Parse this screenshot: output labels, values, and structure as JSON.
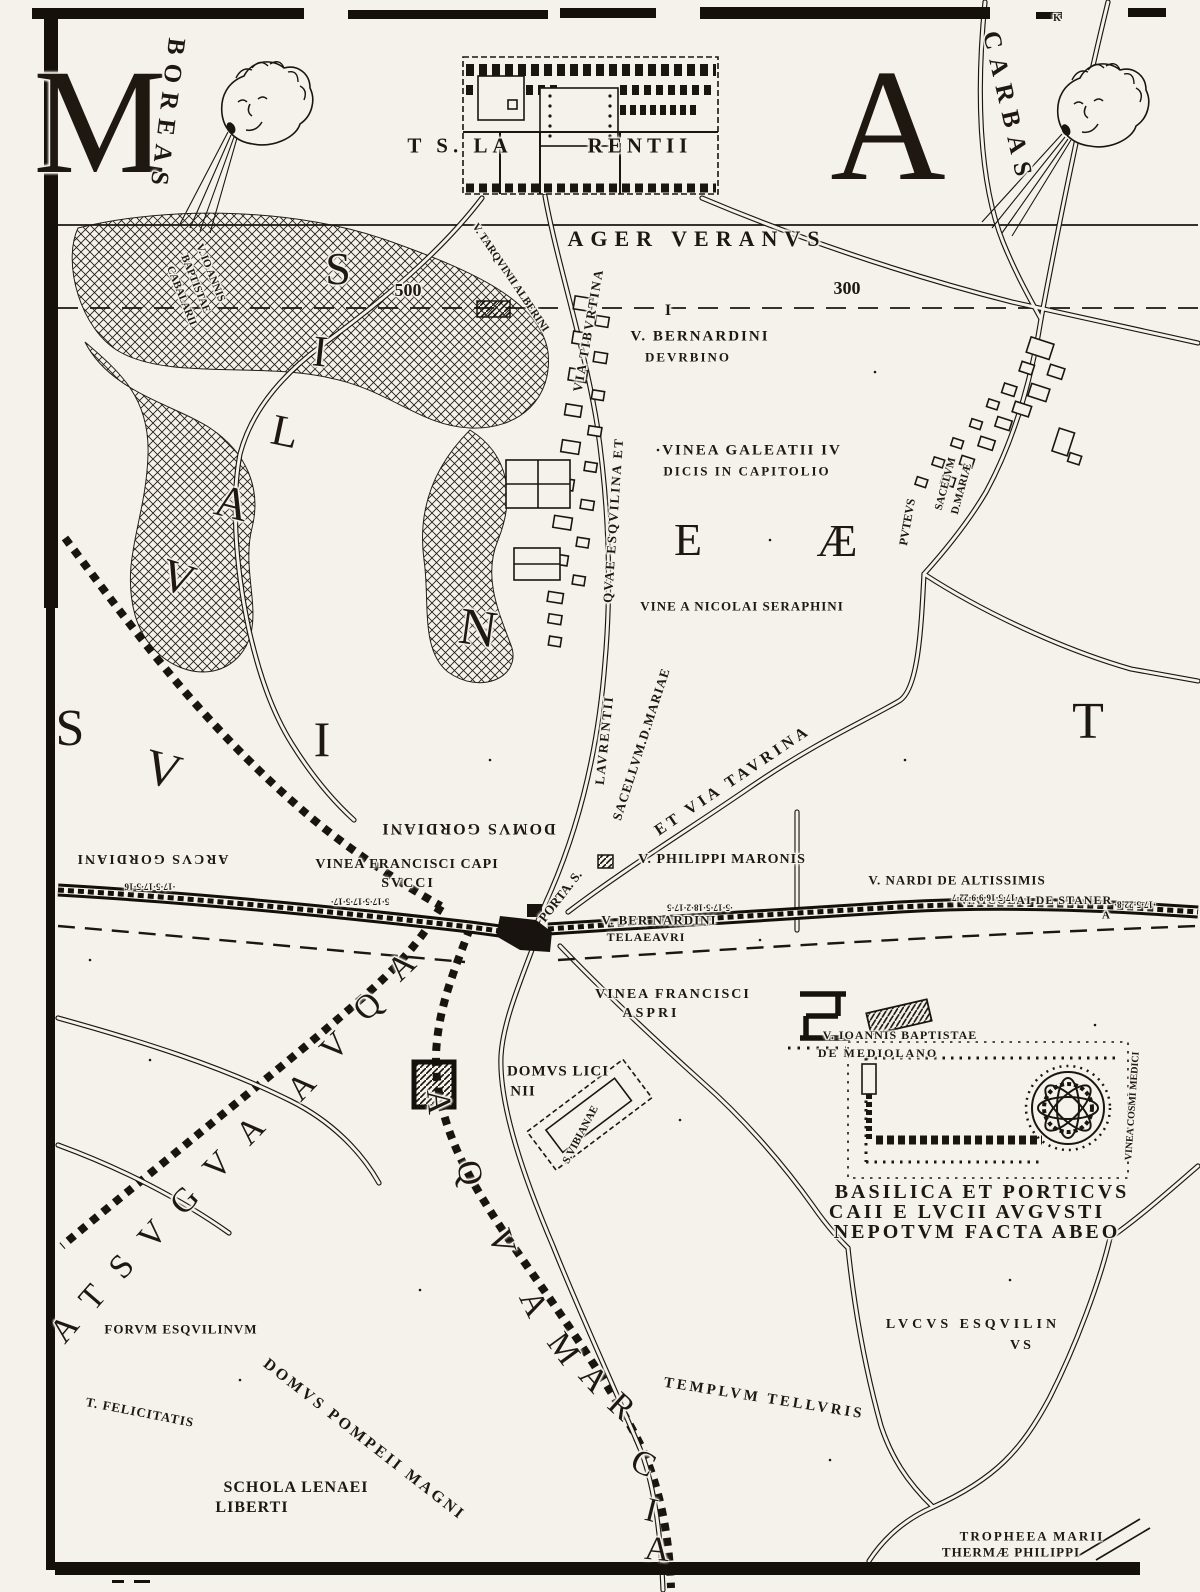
{
  "colors": {
    "paper": "#f5f2ec",
    "ink": "#1f1811"
  },
  "icons": {
    "left_wind_head": "boreas-cherub-head-icon",
    "right_wind_head": "carbas-cherub-head-icon"
  },
  "labels": [
    {
      "n": "sheet-letter-left",
      "t": "M",
      "x": 100,
      "y": 122,
      "s": 150,
      "c": "big"
    },
    {
      "n": "sheet-letter-right",
      "t": "A",
      "x": 888,
      "y": 125,
      "s": 160,
      "c": "big"
    },
    {
      "n": "wind-label-boreas",
      "t": "BOREAS",
      "x": 167,
      "y": 116,
      "s": 25,
      "r": 97,
      "ls": 9
    },
    {
      "n": "wind-label-carbas",
      "t": "CARBAS",
      "x": 1008,
      "y": 108,
      "s": 25,
      "r": 77,
      "ls": 9
    },
    {
      "n": "church-label-left",
      "t": "T S. LA",
      "x": 460,
      "y": 146,
      "s": 21,
      "ls": 5
    },
    {
      "n": "church-label-right",
      "t": "RENTII",
      "x": 640,
      "y": 146,
      "s": 21,
      "ls": 5
    },
    {
      "n": "region-ager-veranus",
      "t": "AGER VERANVS",
      "x": 697,
      "y": 239,
      "s": 22,
      "ls": 7
    },
    {
      "n": "scale-number-500",
      "t": "500",
      "x": 408,
      "y": 290,
      "s": 18
    },
    {
      "n": "scale-number-300",
      "t": "300",
      "x": 847,
      "y": 288,
      "s": 18
    },
    {
      "n": "vineyard-ioannis-cabalarii-1",
      "t": "V. IO ANNIS",
      "x": 210,
      "y": 273,
      "s": 11,
      "r": 68
    },
    {
      "n": "vineyard-ioannis-cabalarii-2",
      "t": "BAPTISTAE",
      "x": 195,
      "y": 284,
      "s": 11,
      "r": 68
    },
    {
      "n": "vineyard-ioannis-cabalarii-3",
      "t": "CABALARII",
      "x": 181,
      "y": 296,
      "s": 11,
      "r": 68
    },
    {
      "n": "vineyard-tarquinii",
      "t": "V. TARQVINII ALBERINI",
      "x": 510,
      "y": 278,
      "s": 11,
      "r": 56
    },
    {
      "n": "road-via-tiburtina",
      "t": "VIA TIBVRTINA",
      "x": 588,
      "y": 330,
      "s": 13,
      "r": -80,
      "ls": 2
    },
    {
      "n": "road-esquilina",
      "t": "QVAE ESQVILINA ET",
      "x": 613,
      "y": 520,
      "s": 13,
      "r": -86,
      "ls": 2
    },
    {
      "n": "road-laurentii",
      "t": "LAVRENTII",
      "x": 604,
      "y": 740,
      "s": 13,
      "r": -84,
      "ls": 2
    },
    {
      "n": "road-porta-s",
      "t": "PORTA. S.",
      "x": 560,
      "y": 896,
      "s": 13,
      "r": -52
    },
    {
      "n": "road-sacellum-mariae",
      "t": "SACELLVM.D.MARIAE",
      "x": 641,
      "y": 744,
      "s": 13,
      "r": -72,
      "ls": 1
    },
    {
      "n": "road-via-taurina",
      "t": "ET VIA TAVRINA",
      "x": 733,
      "y": 781,
      "s": 16,
      "r": -34,
      "ls": 4
    },
    {
      "n": "vineyard-bernardini-urbino-1",
      "t": "V. BERNARDINI",
      "x": 700,
      "y": 337,
      "s": 15,
      "ls": 2
    },
    {
      "n": "vineyard-bernardini-urbino-2",
      "t": "DEVRBINO",
      "x": 688,
      "y": 357,
      "s": 13,
      "ls": 2
    },
    {
      "n": "vineyard-galeatii-1",
      "t": "VINEA GALEATII IV",
      "x": 752,
      "y": 451,
      "s": 15,
      "ls": 2
    },
    {
      "n": "vineyard-galeatii-2",
      "t": "DICIS IN CAPITOLIO",
      "x": 747,
      "y": 471,
      "s": 13,
      "ls": 2
    },
    {
      "n": "sacellum-d-mariae-1",
      "t": "SACELVM",
      "x": 946,
      "y": 484,
      "s": 11,
      "r": -75
    },
    {
      "n": "sacellum-d-mariae-2",
      "t": "D.MARIÆ",
      "x": 962,
      "y": 489,
      "s": 11,
      "r": -75
    },
    {
      "n": "puteus",
      "t": "PVTEVS",
      "x": 907,
      "y": 522,
      "s": 12,
      "r": -80
    },
    {
      "n": "vineyard-nicolai-seraphini",
      "t": "VINE A NICOLAI SERAPHINI",
      "x": 742,
      "y": 606,
      "s": 13,
      "ls": 1
    },
    {
      "n": "domus-gordiani",
      "t": "DOMVS GORDIANI",
      "x": 468,
      "y": 828,
      "s": 16,
      "r": 180,
      "ls": 2
    },
    {
      "n": "arcus-gordiani",
      "t": "ARCVS GORDIANI",
      "x": 152,
      "y": 858,
      "s": 14,
      "r": 180,
      "ls": 2
    },
    {
      "n": "vineyard-francisci-capisucci-1",
      "t": "VINEA FRANCISCI CAPI",
      "x": 407,
      "y": 865,
      "s": 14,
      "ls": 1
    },
    {
      "n": "vineyard-francisci-capisucci-2",
      "t": "SVCCI",
      "x": 408,
      "y": 884,
      "s": 14,
      "ls": 2
    },
    {
      "n": "vineyard-philippi-maronis",
      "t": "V. PHILIPPI MARONIS",
      "x": 722,
      "y": 860,
      "s": 14,
      "ls": 1
    },
    {
      "n": "vineyard-nardi-altissimis",
      "t": "V. NARDI DE ALTISSIMIS",
      "x": 957,
      "y": 880,
      "s": 13,
      "ls": 1
    },
    {
      "n": "vineyard-nicolai-staner",
      "t": "V.NICOLAI DE STANER",
      "x": 1036,
      "y": 900,
      "s": 12,
      "ls": 1
    },
    {
      "n": "staner-mark",
      "t": "A",
      "x": 1106,
      "y": 916,
      "s": 11
    },
    {
      "n": "vineyard-bernardini-telaeauri-1",
      "t": "V. BER NARDINI",
      "x": 659,
      "y": 920,
      "s": 13,
      "ls": 1
    },
    {
      "n": "vineyard-bernardini-telaeauri-2",
      "t": "TELAEAVRI",
      "x": 646,
      "y": 937,
      "s": 12,
      "ls": 1
    },
    {
      "n": "wall-measure-1",
      "t": "·17·5·17·5·16",
      "x": 150,
      "y": 886,
      "s": 9,
      "r": 180
    },
    {
      "n": "wall-measure-2",
      "t": "5·17·5·17·5·17·",
      "x": 360,
      "y": 901,
      "s": 9,
      "r": 180
    },
    {
      "n": "wall-measure-3",
      "t": "·5·17·5·18·2·17·5",
      "x": 700,
      "y": 907,
      "s": 9,
      "r": 180
    },
    {
      "n": "wall-measure-4",
      "t": "·17·5·16·9·9·22·7",
      "x": 985,
      "y": 897,
      "s": 9,
      "r": 180
    },
    {
      "n": "wall-measure-5",
      "t": "·17·5·22·8·",
      "x": 1135,
      "y": 904,
      "s": 9,
      "r": 180
    },
    {
      "n": "vineyard-francisci-aspri-1",
      "t": "VINEA FRANCISCI",
      "x": 673,
      "y": 995,
      "s": 14,
      "ls": 2
    },
    {
      "n": "vineyard-francisci-aspri-2",
      "t": "ASPRI",
      "x": 651,
      "y": 1014,
      "s": 14,
      "ls": 3
    },
    {
      "n": "vineyard-ioannis-mediolano-1",
      "t": "V. IOANNIS BAPTISTAE",
      "x": 900,
      "y": 1035,
      "s": 12,
      "ls": 1
    },
    {
      "n": "vineyard-ioannis-mediolano-2",
      "t": "DE MEDIOLANO",
      "x": 878,
      "y": 1053,
      "s": 12,
      "ls": 2
    },
    {
      "n": "domus-licinii-1",
      "t": "DOMVS LICI",
      "x": 558,
      "y": 1072,
      "s": 15,
      "ls": 1
    },
    {
      "n": "domus-licinii-2",
      "t": "NII",
      "x": 523,
      "y": 1092,
      "s": 15,
      "ls": 1
    },
    {
      "n": "church-s-vibianae",
      "t": "S.VIBIANAE",
      "x": 581,
      "y": 1135,
      "s": 11,
      "r": -62
    },
    {
      "n": "basilica-caption-1",
      "t": "BASILICA ET PORTICVS",
      "x": 982,
      "y": 1192,
      "s": 20,
      "ls": 3
    },
    {
      "n": "basilica-caption-2",
      "t": "CAII E LVCII AVGVSTI",
      "x": 967,
      "y": 1212,
      "s": 20,
      "ls": 3
    },
    {
      "n": "basilica-caption-3",
      "t": "NEPOTVM FACTA ABEO",
      "x": 977,
      "y": 1232,
      "s": 20,
      "ls": 3
    },
    {
      "n": "vineyard-cosmi-medici",
      "t": "VINEA COSMI MEDICI",
      "x": 1133,
      "y": 1106,
      "s": 10,
      "r": -86
    },
    {
      "n": "forum-esquilinum",
      "t": "FORVM ESQVILINVM",
      "x": 181,
      "y": 1329,
      "s": 13,
      "ls": 1
    },
    {
      "n": "templum-felicitatis",
      "t": "T. FELICITATIS",
      "x": 140,
      "y": 1412,
      "s": 13,
      "r": 11,
      "ls": 1
    },
    {
      "n": "domus-pompeii-magni",
      "t": "DOMVS POMPEII MAGNI",
      "x": 364,
      "y": 1440,
      "s": 16,
      "r": 38,
      "ls": 3
    },
    {
      "n": "schola-lenaei-1",
      "t": "SCHOLA LENAEI",
      "x": 296,
      "y": 1488,
      "s": 16,
      "ls": 1
    },
    {
      "n": "schola-lenaei-2",
      "t": "LIBERTI",
      "x": 252,
      "y": 1508,
      "s": 16,
      "ls": 1
    },
    {
      "n": "lucus-esquilinus-1",
      "t": "LVCVS ESQVILIN",
      "x": 973,
      "y": 1325,
      "s": 14,
      "ls": 4
    },
    {
      "n": "lucus-esquilinus-2",
      "t": "VS",
      "x": 1022,
      "y": 1346,
      "s": 14,
      "ls": 3
    },
    {
      "n": "templum-telluris",
      "t": "TEMPLVM TELLVRIS",
      "x": 764,
      "y": 1399,
      "s": 15,
      "r": 9,
      "ls": 3
    },
    {
      "n": "trophaea-marii",
      "t": "TROPHEEA MARII",
      "x": 1032,
      "y": 1536,
      "s": 13,
      "ls": 2
    },
    {
      "n": "thermae-philippi",
      "t": "THERMÆ PHILIPPI",
      "x": 1011,
      "y": 1552,
      "s": 13,
      "ls": 1
    },
    {
      "n": "boundary-mark-i",
      "t": "I",
      "x": 668,
      "y": 311,
      "s": 16
    },
    {
      "n": "frame-mark-top",
      "t": "K",
      "x": 1057,
      "y": 19,
      "s": 10
    },
    {
      "n": "valley-letter-v",
      "t": "V",
      "x": 178,
      "y": 578,
      "s": 46,
      "r": 18,
      "c": "big"
    },
    {
      "n": "valley-letter-a",
      "t": "A",
      "x": 232,
      "y": 503,
      "s": 46,
      "r": 14,
      "c": "big"
    },
    {
      "n": "valley-letter-l",
      "t": "L",
      "x": 285,
      "y": 432,
      "s": 44,
      "r": 12,
      "c": "big"
    },
    {
      "n": "valley-letter-i",
      "t": "I",
      "x": 320,
      "y": 352,
      "s": 44,
      "r": 6,
      "c": "big"
    },
    {
      "n": "valley-letter-s",
      "t": "S",
      "x": 338,
      "y": 269,
      "s": 46,
      "c": "big"
    },
    {
      "n": "region-letter-s",
      "t": "S",
      "x": 70,
      "y": 729,
      "s": 52,
      "c": "big"
    },
    {
      "n": "region-letter-v",
      "t": "V",
      "x": 163,
      "y": 769,
      "s": 50,
      "r": 15,
      "c": "big"
    },
    {
      "n": "region-letter-i",
      "t": "I",
      "x": 322,
      "y": 739,
      "s": 50,
      "c": "big"
    },
    {
      "n": "region-letter-n",
      "t": "N",
      "x": 478,
      "y": 629,
      "s": 52,
      "r": 8,
      "c": "big"
    },
    {
      "n": "region-letter-e",
      "t": "E",
      "x": 688,
      "y": 540,
      "s": 46,
      "c": "big"
    },
    {
      "n": "region-letter-ae",
      "t": "Æ",
      "x": 837,
      "y": 541,
      "s": 46,
      "c": "big"
    },
    {
      "n": "region-letter-t",
      "t": "T",
      "x": 1088,
      "y": 722,
      "s": 52,
      "c": "big"
    },
    {
      "n": "aqua-augusta-a1",
      "t": "A",
      "x": 402,
      "y": 967,
      "s": 34,
      "r": -44,
      "c": "big"
    },
    {
      "n": "aqua-augusta-q",
      "t": "Q",
      "x": 368,
      "y": 1007,
      "s": 34,
      "r": -44,
      "c": "big"
    },
    {
      "n": "aqua-augusta-v1",
      "t": "V",
      "x": 335,
      "y": 1047,
      "s": 34,
      "r": -45,
      "c": "big"
    },
    {
      "n": "aqua-augusta-a2",
      "t": "A",
      "x": 302,
      "y": 1087,
      "s": 34,
      "r": -46,
      "c": "big"
    },
    {
      "n": "aqua-augusta-a3",
      "t": "A",
      "x": 251,
      "y": 1131,
      "s": 34,
      "r": -46,
      "c": "big"
    },
    {
      "n": "aqua-augusta-v2",
      "t": "V",
      "x": 218,
      "y": 1166,
      "s": 34,
      "r": -46,
      "c": "big"
    },
    {
      "n": "aqua-augusta-g",
      "t": "G",
      "x": 185,
      "y": 1201,
      "s": 34,
      "r": -47,
      "c": "big"
    },
    {
      "n": "aqua-augusta-v3",
      "t": "V",
      "x": 153,
      "y": 1235,
      "s": 34,
      "r": -48,
      "c": "big"
    },
    {
      "n": "aqua-augusta-s",
      "t": "S",
      "x": 122,
      "y": 1267,
      "s": 34,
      "r": -48,
      "c": "big"
    },
    {
      "n": "aqua-augusta-t",
      "t": "T",
      "x": 93,
      "y": 1298,
      "s": 34,
      "r": -49,
      "c": "big"
    },
    {
      "n": "aqua-augusta-a4",
      "t": "A",
      "x": 65,
      "y": 1329,
      "s": 34,
      "r": -50,
      "c": "big"
    },
    {
      "n": "aqua-marcia-a1",
      "t": "A",
      "x": 438,
      "y": 1102,
      "s": 34,
      "r": 85,
      "c": "big"
    },
    {
      "n": "aqua-marcia-q",
      "t": "Q",
      "x": 469,
      "y": 1173,
      "s": 34,
      "r": 78,
      "c": "big"
    },
    {
      "n": "aqua-marcia-v",
      "t": "V",
      "x": 501,
      "y": 1242,
      "s": 34,
      "r": 72,
      "c": "big"
    },
    {
      "n": "aqua-marcia-a2",
      "t": "A",
      "x": 533,
      "y": 1304,
      "s": 34,
      "r": 64,
      "c": "big"
    },
    {
      "n": "aqua-marcia-m",
      "t": "M",
      "x": 563,
      "y": 1349,
      "s": 34,
      "r": 54,
      "c": "big"
    },
    {
      "n": "aqua-marcia-a3",
      "t": "A",
      "x": 593,
      "y": 1379,
      "s": 34,
      "r": 48,
      "c": "big"
    },
    {
      "n": "aqua-marcia-r",
      "t": "R",
      "x": 621,
      "y": 1407,
      "s": 34,
      "r": 42,
      "c": "big"
    },
    {
      "n": "aqua-marcia-c",
      "t": "C",
      "x": 643,
      "y": 1464,
      "s": 34,
      "r": 26,
      "c": "big"
    },
    {
      "n": "aqua-marcia-i",
      "t": "I",
      "x": 651,
      "y": 1511,
      "s": 34,
      "r": 14,
      "c": "big"
    },
    {
      "n": "aqua-marcia-a4",
      "t": "A",
      "x": 657,
      "y": 1550,
      "s": 34,
      "r": 6,
      "c": "big"
    }
  ]
}
